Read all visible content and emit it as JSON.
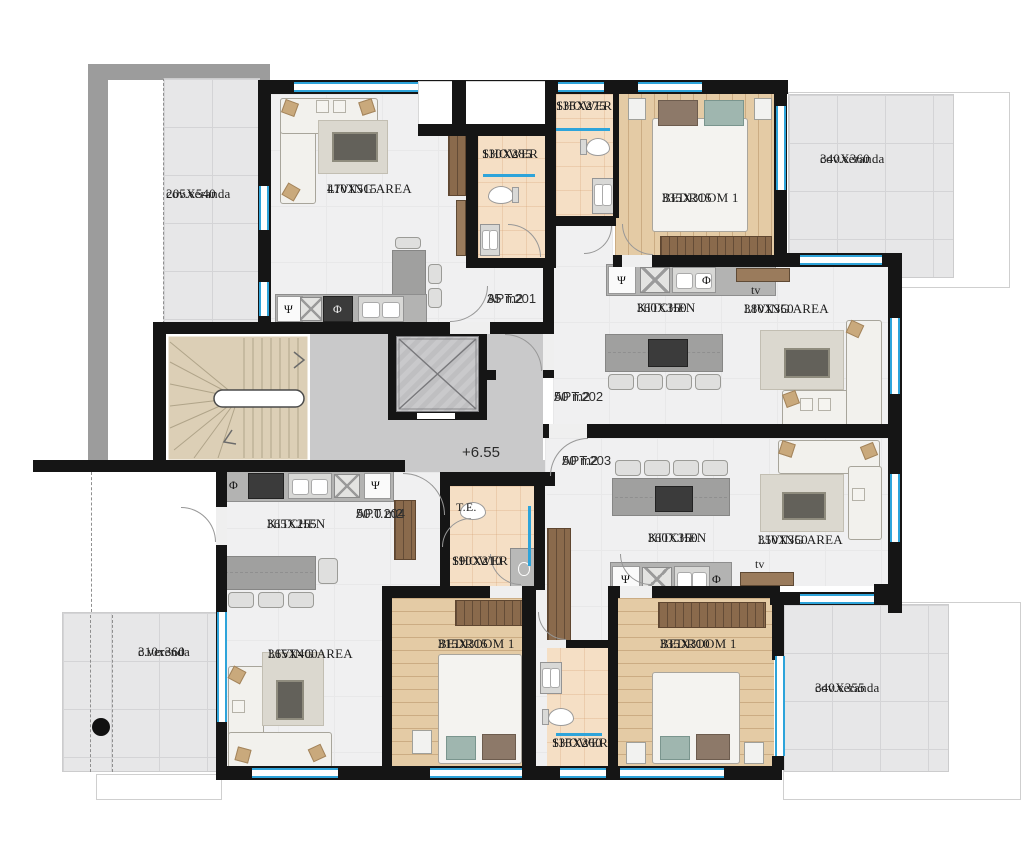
{
  "level_label": "+6.55",
  "apartments": [
    {
      "id": "APT.201",
      "area": "35 m2"
    },
    {
      "id": "APT.202",
      "area": "50 m2"
    },
    {
      "id": "APT.203",
      "area": "50 m2"
    },
    {
      "id": "APT.204",
      "area": "50.0 m2"
    }
  ],
  "rooms": {
    "veranda_tl": {
      "name": "cov.veranda",
      "dims": "205X540"
    },
    "living_201": {
      "name": "LIVING AREA",
      "dims": "470X515"
    },
    "shower_201": {
      "name": "SHOWER",
      "dims": "130X285"
    },
    "shower_202": {
      "name": "SHOWER",
      "dims": "135X275"
    },
    "bedroom_202": {
      "name": "BEDROOM 1",
      "dims": "335X315"
    },
    "veranda_tr": {
      "name": "cov.veranda",
      "dims": "340X360"
    },
    "kitchen_202": {
      "name": "KITCHEN",
      "dims": "360X350"
    },
    "living_202": {
      "name": "LIVING AREA",
      "dims": "380X350"
    },
    "kitchen_204": {
      "name": "KITCHEN",
      "dims": "365X255"
    },
    "living_204": {
      "name": "LIVING AREA",
      "dims": "365X400"
    },
    "veranda_bl": {
      "name": "c.verenda",
      "dims": "310x360"
    },
    "te": {
      "name": "T.E."
    },
    "shower_204": {
      "name": "SHOWER",
      "dims": "190X210"
    },
    "bedroom_204": {
      "name": "BEDROOM 1",
      "dims": "315X315"
    },
    "shower_203": {
      "name": "SHOWER",
      "dims": "135X260"
    },
    "bedroom_203": {
      "name": "BEDROOM 1",
      "dims": "335X310"
    },
    "kitchen_203": {
      "name": "KITCHEN",
      "dims": "360X350"
    },
    "living_203": {
      "name": "LIVING AREA",
      "dims": "350X350"
    },
    "veranda_br": {
      "name": "cov.veranda",
      "dims": "340X355"
    }
  },
  "symbols": {
    "psi": "Ψ",
    "phi": "Φ",
    "tv": "tv"
  },
  "colors": {
    "wall": "#151515",
    "window_blue": "#2ea4da",
    "veranda_tile": "#e7e7e8",
    "wood_floor": "#e4cba5",
    "shower_floor": "#f5dfc5",
    "corridor": "#c9c9ca",
    "stairs": "#dccfb6"
  }
}
